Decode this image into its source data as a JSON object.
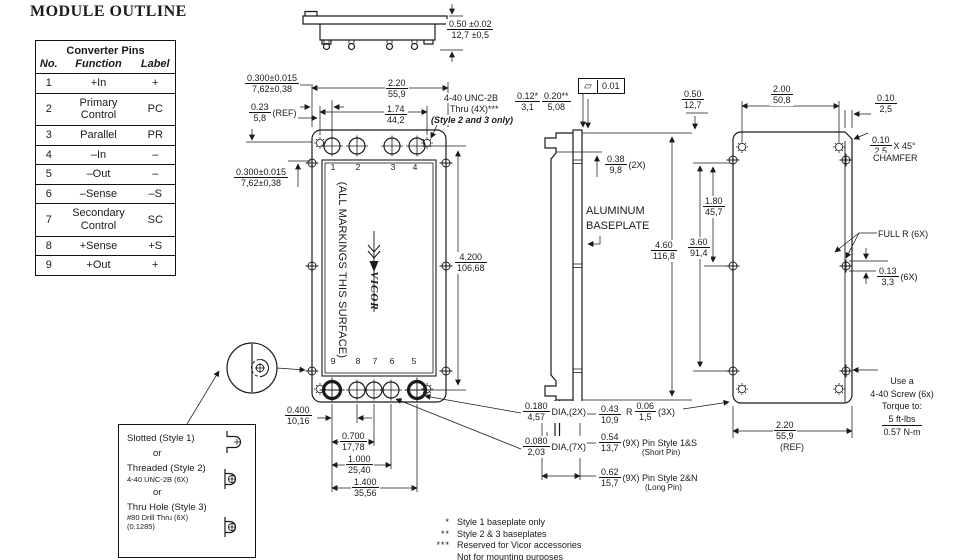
{
  "title": "MODULE OUTLINE",
  "pin_table": {
    "title": "Converter Pins",
    "headers": [
      "No.",
      "Function",
      "Label"
    ],
    "rows": [
      [
        "1",
        "+In",
        "+"
      ],
      [
        "2",
        "Primary Control",
        "PC"
      ],
      [
        "3",
        "Parallel",
        "PR"
      ],
      [
        "4",
        "–In",
        "–"
      ],
      [
        "5",
        "–Out",
        "–"
      ],
      [
        "6",
        "–Sense",
        "–S"
      ],
      [
        "7",
        "Secondary Control",
        "SC"
      ],
      [
        "8",
        "+Sense",
        "+S"
      ],
      [
        "9",
        "+Out",
        "+"
      ]
    ]
  },
  "styles_box": {
    "style1": "Slotted (Style 1)",
    "or1": "or",
    "style2": "Threaded (Style 2)",
    "style2_sub": "4-40 UNC-2B (6X)",
    "or2": "or",
    "style3": "Thru Hole (Style 3)",
    "style3_sub1": "#80 Drill Thru (6X)",
    "style3_sub2": "(0.1285)"
  },
  "front_view": {
    "marking_text": "(ALL MARKINGS THIS SURFACE)",
    "logo_text": "VICOR",
    "top_pin_numbers": [
      "1",
      "2",
      "3",
      "4"
    ],
    "bottom_pin_numbers": [
      "9",
      "8",
      "7",
      "6",
      "5"
    ]
  },
  "gdt": {
    "symbol": "▱",
    "value": "0.01"
  },
  "torque": {
    "l1": "Use a",
    "l2": "4-40 Screw (6x)",
    "l3": "Torque to:",
    "l4": "5 ft-lbs",
    "l5": "0.57 N-m"
  },
  "notes": [
    {
      "m": "*",
      "t": "Style 1 baseplate only"
    },
    {
      "m": "**",
      "t": "Style 2 & 3 baseplates"
    },
    {
      "m": "***",
      "t": "Reserved for Vicor accessories"
    },
    {
      "m": "",
      "t": "Not for mounting purposes"
    }
  ],
  "dim_labels": [
    {
      "name": "dim-module-thickness",
      "x": 446,
      "y": 19,
      "top": "0.50 ±0.02",
      "bottom": "12,7 ±0,5"
    },
    {
      "name": "dim-module-width",
      "x": 385,
      "y": 78,
      "top": "2.20",
      "bottom": "55,9"
    },
    {
      "name": "dim-mount-hole-span",
      "x": 384,
      "y": 104,
      "top": "1.74",
      "bottom": "44,2"
    },
    {
      "name": "dim-pin-edge-offset-top",
      "x": 244,
      "y": 73,
      "top": "0.300±0.015",
      "bottom": "7,62±0,38"
    },
    {
      "name": "dim-ref-offset",
      "x": 248,
      "y": 102,
      "top": "0.23",
      "bottom": "5,8",
      "suffix": "(REF)"
    },
    {
      "name": "dim-pin-edge-offset-left",
      "x": 233,
      "y": 167,
      "top": "0.300±0.015",
      "bottom": "7,62±0,38"
    },
    {
      "name": "dim-module-length",
      "x": 454,
      "y": 252,
      "top": "4.200",
      "bottom": "106,68"
    },
    {
      "name": "dim-thread-depth-1",
      "x": 514,
      "y": 91,
      "top": "0.12*",
      "bottom": "3,1"
    },
    {
      "name": "dim-thread-depth-2",
      "x": 541,
      "y": 91,
      "top": "0.20**",
      "bottom": "5,08"
    },
    {
      "name": "dim-standoff",
      "x": 604,
      "y": 154,
      "top": "0.38",
      "bottom": "9,8",
      "suffix": "(2X)"
    },
    {
      "name": "dim-back-top-offset",
      "x": 681,
      "y": 89,
      "top": "0.50",
      "bottom": "12,7"
    },
    {
      "name": "dim-back-hole-span",
      "x": 770,
      "y": 84,
      "top": "2.00",
      "bottom": "50,8"
    },
    {
      "name": "dim-edge-strip",
      "x": 874,
      "y": 93,
      "top": "0.10",
      "bottom": "2,5"
    },
    {
      "name": "dim-chamfer",
      "x": 869,
      "y": 135,
      "top": "0.10",
      "bottom": "2,5",
      "suffix": "X 45°"
    },
    {
      "name": "dim-slot-span-1",
      "x": 702,
      "y": 196,
      "top": "1.80",
      "bottom": "45,7"
    },
    {
      "name": "dim-slot-span-2",
      "x": 687,
      "y": 237,
      "top": "3.60",
      "bottom": "91,4"
    },
    {
      "name": "dim-back-height",
      "x": 650,
      "y": 240,
      "top": "4.60",
      "bottom": "116,8"
    },
    {
      "name": "dim-slot-offset",
      "x": 876,
      "y": 266,
      "top": "0.13",
      "bottom": "3,3",
      "suffix": "(6X)"
    },
    {
      "name": "dim-corner-radius",
      "x": 625,
      "y": 401,
      "prefix": "R",
      "top": "0.06",
      "bottom": "1,5",
      "suffix": "(3X)"
    },
    {
      "name": "dim-back-width-ref",
      "x": 773,
      "y": 420,
      "top": "2.20",
      "bottom": "55,9"
    },
    {
      "name": "dim-pin-inset",
      "x": 598,
      "y": 404,
      "top": "0.43",
      "bottom": "10,9"
    },
    {
      "name": "dim-short-pin",
      "x": 598,
      "y": 432,
      "top": "0.54",
      "bottom": "13,7",
      "suffix": "(9X) Pin Style 1&S"
    },
    {
      "name": "dim-long-pin",
      "x": 598,
      "y": 467,
      "top": "0.62",
      "bottom": "15,7",
      "suffix": "(9X) Pin Style 2&N"
    },
    {
      "name": "dim-pin-spacing-1",
      "x": 284,
      "y": 405,
      "top": "0.400",
      "bottom": "10,16"
    },
    {
      "name": "dim-pin-spacing-2",
      "x": 339,
      "y": 431,
      "top": "0.700",
      "bottom": "17,78"
    },
    {
      "name": "dim-pin-spacing-3",
      "x": 345,
      "y": 454,
      "top": "1.000",
      "bottom": "25,40"
    },
    {
      "name": "dim-pin-spacing-4",
      "x": 351,
      "y": 477,
      "top": "1.400",
      "bottom": "35,56"
    },
    {
      "name": "dim-pin-dia-large",
      "x": 522,
      "y": 401,
      "top": "0.180",
      "bottom": "4,57",
      "suffix": "DIA,(2X)"
    },
    {
      "name": "dim-pin-dia-small",
      "x": 522,
      "y": 436,
      "top": "0.080",
      "bottom": "2,03",
      "suffix": "DIA,(7X)"
    }
  ],
  "text_labels": [
    {
      "name": "thread-note-1",
      "x": 443,
      "y": 93,
      "t": "4-40 UNC-2B"
    },
    {
      "name": "thread-note-2",
      "x": 449,
      "y": 104,
      "t": "Thru (4X)***"
    },
    {
      "name": "thread-note-3",
      "x": 430,
      "y": 115,
      "t": "(Style 2 and 3 only)",
      "b": true,
      "i": true
    },
    {
      "name": "aluminum-baseplate-label-1",
      "x": 585,
      "y": 205,
      "t": "ALUMINUM",
      "s": 11
    },
    {
      "name": "aluminum-baseplate-label-2",
      "x": 585,
      "y": 220,
      "t": "BASEPLATE",
      "s": 11
    },
    {
      "name": "full-radius-label",
      "x": 877,
      "y": 229,
      "t": "FULL R (6X)"
    },
    {
      "name": "chamfer-label",
      "x": 872,
      "y": 153,
      "t": "CHAMFER"
    },
    {
      "name": "short-pin-label",
      "x": 641,
      "y": 448,
      "t": "(Short Pin)",
      "s": 8
    },
    {
      "name": "long-pin-label",
      "x": 644,
      "y": 483,
      "t": "(Long Pin)",
      "s": 8
    },
    {
      "name": "ref-label",
      "x": 779,
      "y": 442,
      "t": "(REF)"
    }
  ]
}
